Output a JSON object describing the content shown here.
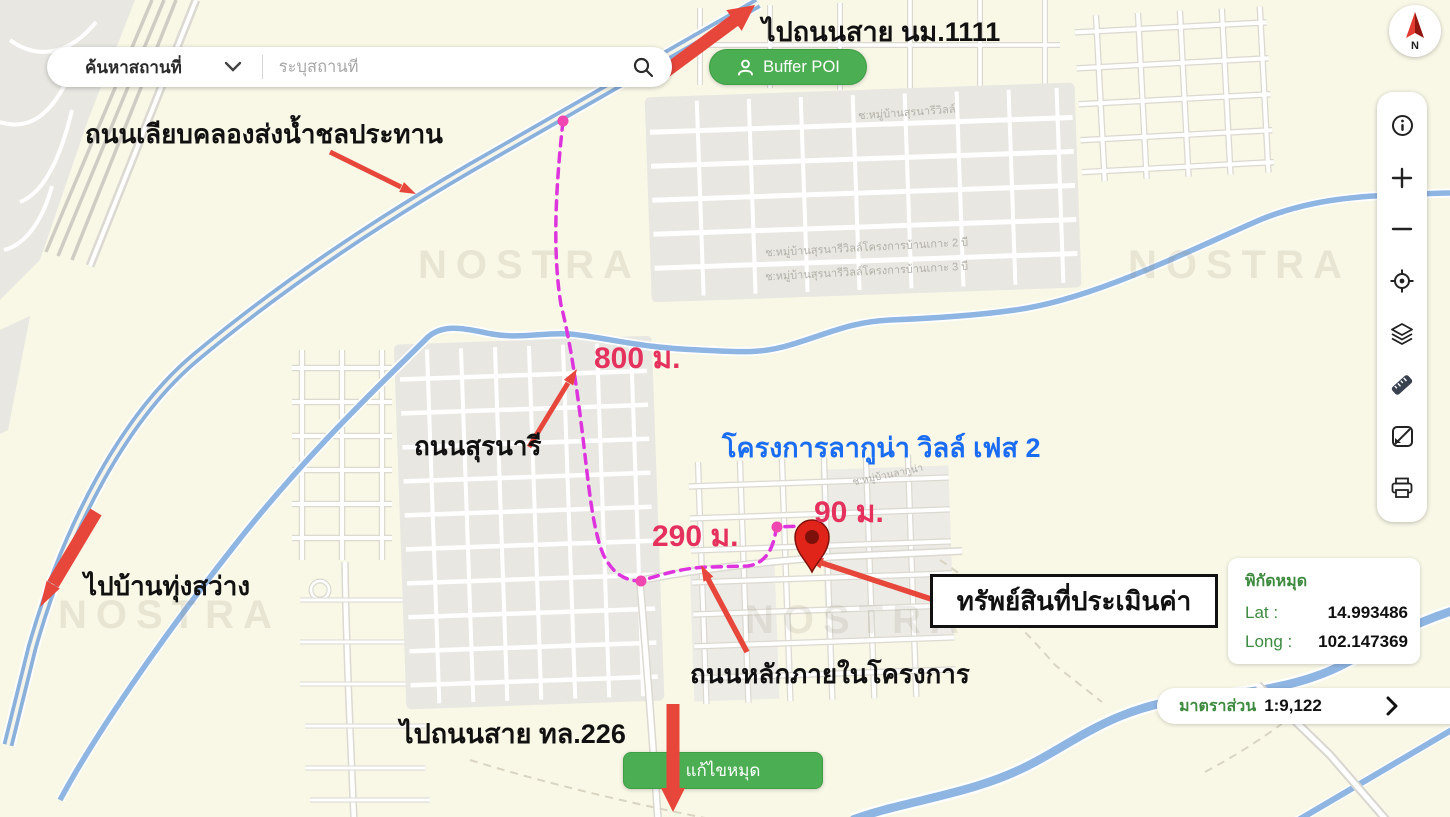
{
  "search_bar": {
    "category_label": "ค้นหาสถานที่",
    "placeholder": "ระบุสถานที่"
  },
  "buttons": {
    "buffer_poi": "Buffer POI",
    "edit_pin": "แก้ไขหมุด"
  },
  "annotations": {
    "to_road_nm1111": "ไปถนนสาย นม.1111",
    "canal_road": "ถนนเลียบคลองส่งน้ำชลประทาน",
    "to_ban_thung_sawang": "ไปบ้านทุ่งสว่าง",
    "suranari_road": "ถนนสุรนารี",
    "project_name": "โครงการลากูน่า วิลล์ เฟส 2",
    "internal_road": "ถนนหลักภายในโครงการ",
    "to_road_226": "ไปถนนสาย ทล.226",
    "property_label": "ทรัพย์สินที่ประเมินค่า",
    "dist_800": "800 ม.",
    "dist_290": "290 ม.",
    "dist_90": "90 ม."
  },
  "map_labels": {
    "village_1": "ช:หมู่บ้านสุรนารีวิลล์",
    "village_2": "ช:หมู่บ้านสุรนารีวิลล์โครงการบ้านเกาะ 2 บี",
    "village_3": "ช:หมู่บ้านสุรนารีวิลล์โครงการบ้านเกาะ 3 บี",
    "village_4": "ช:หมู่บ้านลากูน่า",
    "watermark": "NOSTRA"
  },
  "coordinates_panel": {
    "title": "พิกัดหมุด",
    "lat_label": "Lat :",
    "lat_value": "14.993486",
    "long_label": "Long :",
    "long_value": "102.147369"
  },
  "scale_bar": {
    "label": "มาตราส่วน",
    "value": "1:9,122"
  },
  "compass": {
    "letter": "N"
  },
  "toolbar": {
    "icons": [
      "info-icon",
      "zoom-in-icon",
      "zoom-out-icon",
      "locate-icon",
      "layers-icon",
      "measure-icon",
      "basemap-icon",
      "print-icon"
    ]
  },
  "colors": {
    "accent_green": "#4cae52",
    "route_magenta": "#de34de",
    "waypoint_pink": "#ef46b0",
    "distance_pink": "#e5315e",
    "arrow_red": "#e7463b",
    "project_blue": "#1a6df2",
    "coord_green": "#3e8b40",
    "water_blue": "#8fb5e2",
    "map_background": "#f9f7e6"
  }
}
